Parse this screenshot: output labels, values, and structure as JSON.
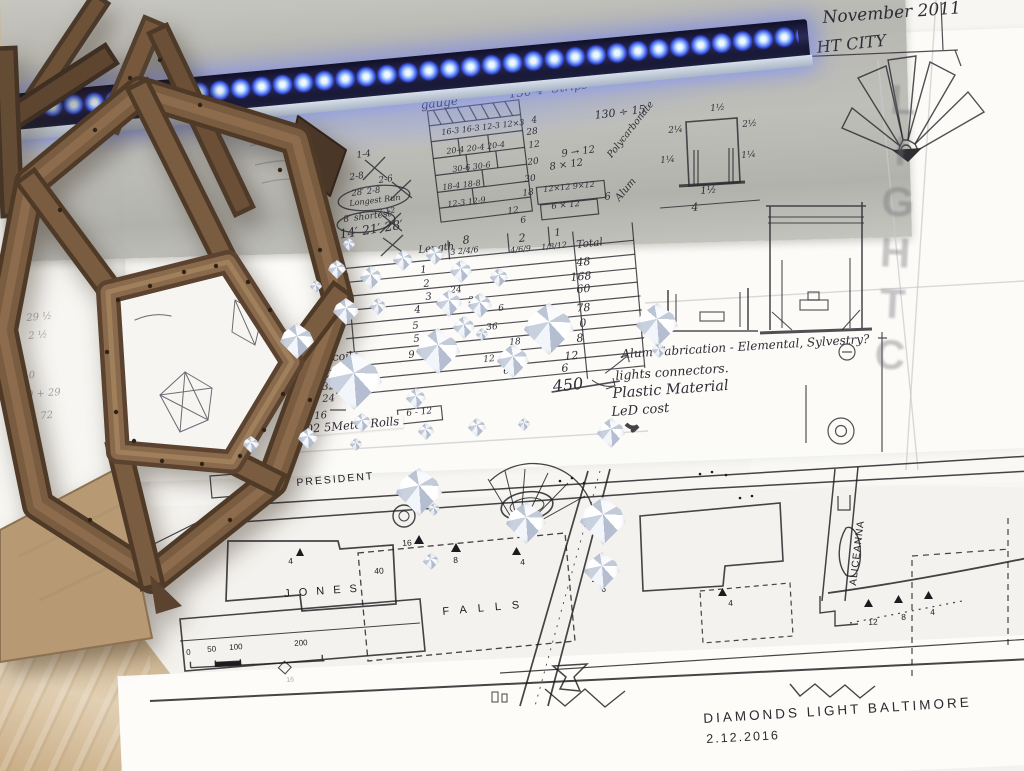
{
  "scene": {
    "description": "Worktable photo: Diamonds Light Baltimore design sketches, LED strip, wooden model, crystal diamonds"
  },
  "header": {
    "date": "November 2011",
    "city": "HT CITY"
  },
  "watermark": "LIGHTC",
  "palette": {
    "led_blue": "#3c55e8",
    "wood_brown": "#7a5c41",
    "map_grey": "#b6b6b0",
    "paper": "#fbfaf7"
  },
  "top_notes": {
    "diamonds": "[48 Diamonds]",
    "gauge": "gauge",
    "strips": "130-4″ Strips",
    "division": "130 ÷ 15"
  },
  "cut_grid": {
    "rows": [
      "16-3  16-3  12-3  12×3",
      "20-4   20-4   20-4",
      "30-6     30-6",
      "18-4      18-8",
      "12-3     12-9"
    ],
    "totals": [
      "4",
      "28",
      "12",
      "20",
      "30",
      "18",
      "12",
      "6"
    ],
    "side_a": "9 → 12",
    "side_b": "8 × 12",
    "side_box1": "12×12    9×12",
    "side_box2": "6 × 12",
    "side_total": "6"
  },
  "run_notes": {
    "x1": "1-4",
    "x2": "2-8",
    "x3": "2-6",
    "longest": "28′ 2-8",
    "longest2": "Longest Run",
    "mid": "7-12",
    "shortest": "8′ shortest",
    "lengths": "7′ 14′ 21′ 28′"
  },
  "length_table": {
    "col_length": "Length",
    "col8": "8",
    "col8b": "3   2/4/6",
    "col2": "2",
    "col2b": "4/6/9",
    "col1": "1",
    "col1b": "1/8/12",
    "col_total": "Total",
    "rows": [
      {
        "n": "1",
        "mid": "",
        "t": "48"
      },
      {
        "n": "2",
        "mid": "24",
        "t": "168"
      },
      {
        "n": "3",
        "mid": "2",
        "t": "60"
      },
      {
        "n": "4",
        "mid": "6",
        "t": "78"
      },
      {
        "n": "5",
        "mid": "36",
        "t": "0"
      },
      {
        "n": "5",
        "mid": "18",
        "t": "8"
      },
      {
        "n": "9",
        "mid": "12",
        "t": "12"
      },
      {
        "n": "",
        "mid": "6",
        "t": "6"
      }
    ],
    "grand": "450"
  },
  "coils": {
    "label": "coils",
    "v1": "32",
    "v2": "32",
    "v3": "24",
    "v4": "16",
    "six_twelve": "6 - 12",
    "rolls": "102 5Meter Rolls"
  },
  "fab_notes": {
    "l1": "Alum Fabrication - Elemental, Sylvestry?",
    "l2": "lights connectors.",
    "l3": "Plastic Material",
    "l4": "LeD cost"
  },
  "profile": {
    "mat_top": "Polycarbonate",
    "mat_bottom": "Alum",
    "d_top": "1½",
    "d_left1": "2¼",
    "d_right1": "2½",
    "d_left2": "1¼",
    "d_right2": "1¼",
    "d_bottom": "1½",
    "d_width": "4"
  },
  "map": {
    "street_president": "PRESIDENT",
    "street_jones": "JONES",
    "street_falls": "FALLS",
    "street_aliceanna": "ALICEANNA",
    "scale": {
      "s0": "0",
      "s1": "50",
      "s2": "100",
      "s3": "200",
      "s4": "16"
    },
    "markers": {
      "m16": "16",
      "m4a": "4",
      "m40": "40",
      "m8": "8",
      "m4b": "4",
      "m6": "6",
      "m4c": "4",
      "m12": "12",
      "m8b": "8",
      "m4d": "4"
    }
  },
  "footer": {
    "title": "DIAMONDS LIGHT BALTIMORE",
    "date": "2.12.2016"
  },
  "faint_notes": {
    "f1": "29 ½",
    "f2": "2 ½",
    "f3": "40",
    "f4": "170 + 29",
    "f5": "72"
  }
}
